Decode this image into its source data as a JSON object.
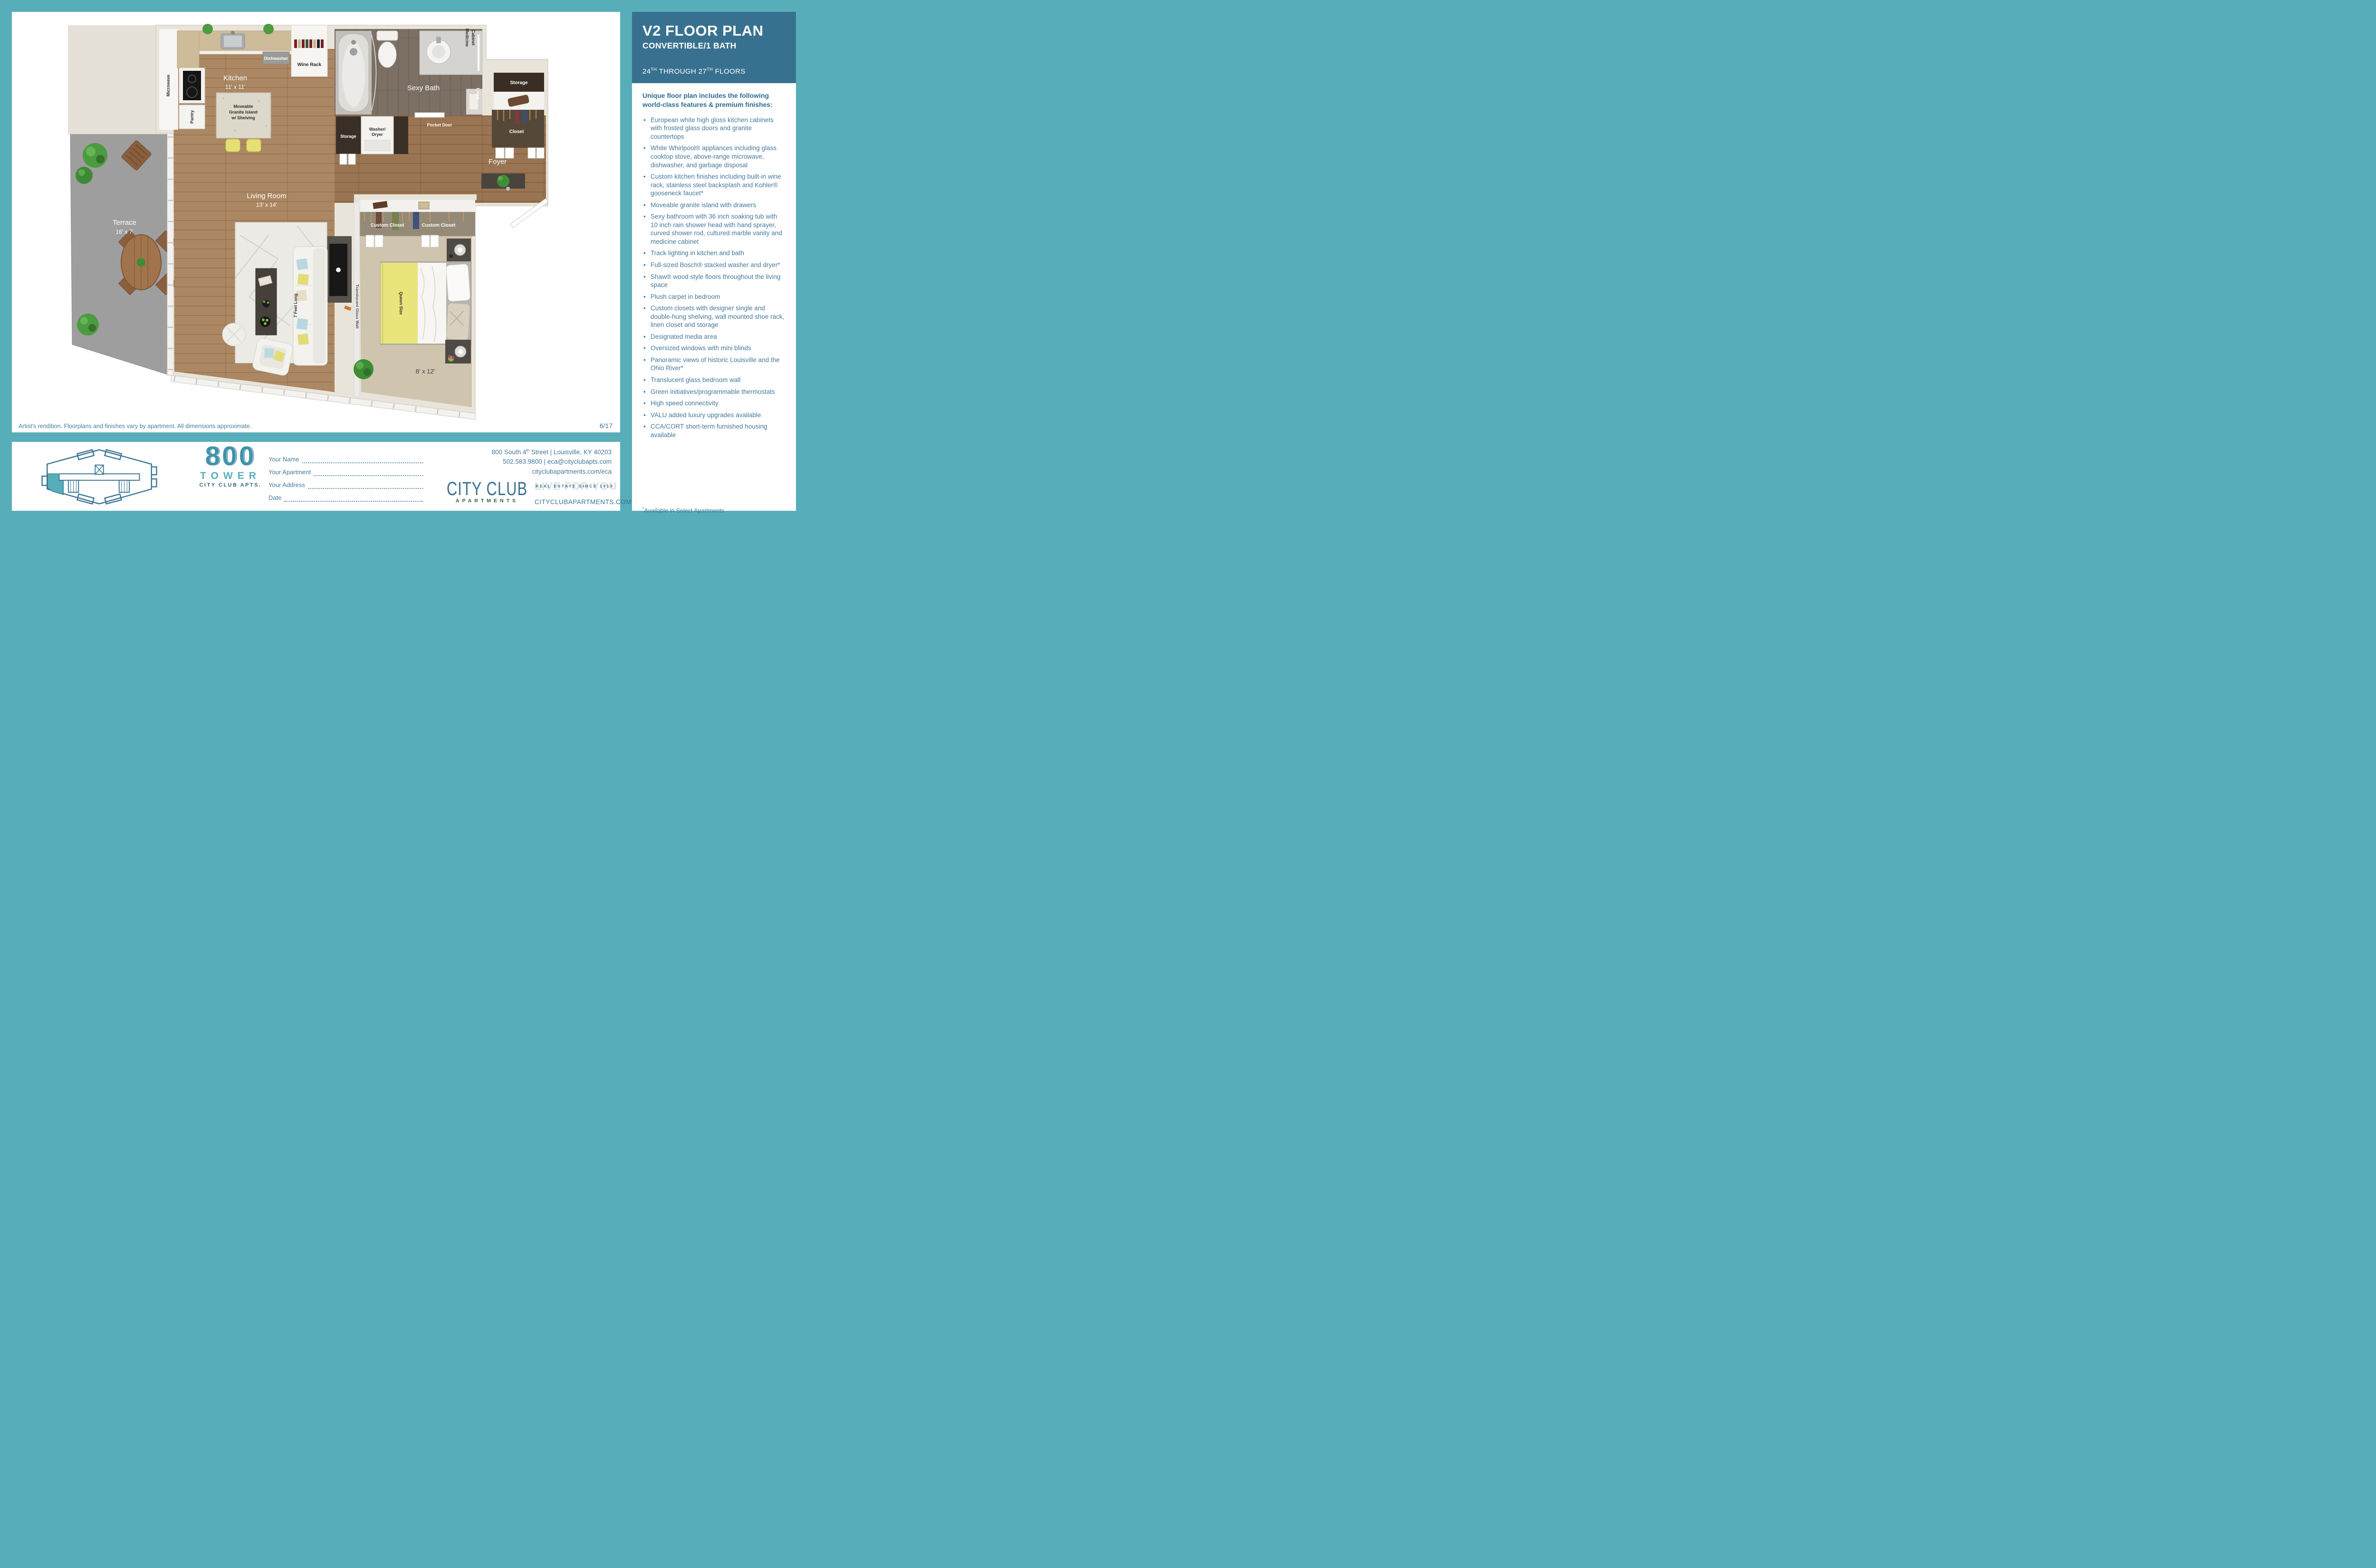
{
  "header": {
    "title": "V2 FLOOR PLAN",
    "subtitle": "CONVERTIBLE/1 BATH",
    "floors_prefix": "24",
    "floors_sup1": "TH",
    "floors_mid": " THROUGH 27",
    "floors_sup2": "TH",
    "floors_suffix": " FLOORS"
  },
  "features": {
    "intro": "Unique floor plan includes the following world-class features & premium finishes:",
    "items": [
      "European white high gloss kitchen cabinets with frosted glass doors and granite countertops",
      "White Whirlpool® appliances including glass cooktop stove, above-range microwave, dishwasher, and garbage disposal",
      "Custom kitchen finishes including built-in wine rack, stainless steel backsplash and Kohler® gooseneck faucet*",
      "Moveable granite island with drawers",
      "Sexy bathroom with 36 inch soaking tub with 10 inch rain shower head with hand sprayer, curved shower rod, cultured marble vanity and medicine cabinet",
      "Track lighting in kitchen and bath",
      "Full-sized Bosch® stacked washer and dryer*",
      "Shaw® wood style floors throughout the living space",
      "Plush carpet in bedroom",
      "Custom closets with designer single and double-hung shelving, wall mounted shoe rack, linen closet and storage",
      "Designated media area",
      "Oversized windows with mini blinds",
      "Panoramic views of historic Louisville and the Ohio River*",
      "Translucent glass bedroom wall",
      "Green initiatives/programmable thermostats",
      "High speed connectivity",
      "VALU added luxury upgrades available",
      "CCA/CORT short-term furnished housing available"
    ],
    "footnote_star": "*",
    "footnote": "Available in Select Apartments"
  },
  "floorplan": {
    "caption": "Artist's rendition. Floorplans and finishes vary by apartment. All dimensions approximate.",
    "page_number": "6/17",
    "labels": {
      "kitchen": "Kitchen",
      "kitchen_dims": "11' x 11'",
      "island_1": "Moveable",
      "island_2": "Granite Island",
      "island_3": "w/ Shelving",
      "dishwasher": "Dishwasher",
      "wine_rack": "Wine Rack",
      "microwave": "Microwave",
      "pantry": "Pantry",
      "sexy_bath": "Sexy Bath",
      "medicine_1": "Medicine",
      "medicine_2": "Cabinet",
      "pocket_door": "Pocket Door",
      "linen": "Linen",
      "storage_top": "Storage",
      "closet": "Closet",
      "foyer": "Foyer",
      "storage_wd": "Storage",
      "washer_1": "Washer/",
      "washer_2": "Dryer",
      "custom_closet_1": "Custom Closet",
      "custom_closet_2": "Custom Closet",
      "queen_size": "Queen Size",
      "bedroom_dims": "8' x 12'",
      "translucent": "Translucent Glass Wall",
      "living_room": "Living Room",
      "living_dims": "13' x 14'",
      "seven_feet": "7 Feet Long",
      "terrace": "Terrace",
      "terrace_dims": "16' x 7'"
    }
  },
  "footer": {
    "logo800": {
      "number": "800",
      "name": "TOWER",
      "sub": "CITY CLUB APTS."
    },
    "form": [
      {
        "label": "Your Name"
      },
      {
        "label": "Your Apartment"
      },
      {
        "label": "Your Address"
      },
      {
        "label": "Date"
      }
    ],
    "contact": {
      "addr1": "800 South 4",
      "addr_sup": "th",
      "addr2": " Street | Louisville, KY 40203",
      "line2": "502.583.9800 | eca@cityclubapts.com",
      "line3": "cityclubapartments.com/eca"
    },
    "cityclub": {
      "name": "CITY CLUB",
      "sub": "APARTMENTS",
      "tagline_bg": "LIVE FOR YOU",
      "tagline": "REAL ESTATE SINCE 1919",
      "site": "CITYCLUBAPARTMENTS.COM"
    }
  },
  "colors": {
    "teal": "#57aeb9",
    "header_bg": "#38718f",
    "text_blue": "#44799b",
    "wood": "#ab8763",
    "bath_floor": "#7c7064",
    "carpet": "#cfc4ae",
    "terrace_gray": "#9e9e9e",
    "wall_cream": "#e9e4da",
    "accent_yellow": "#eae47c"
  }
}
